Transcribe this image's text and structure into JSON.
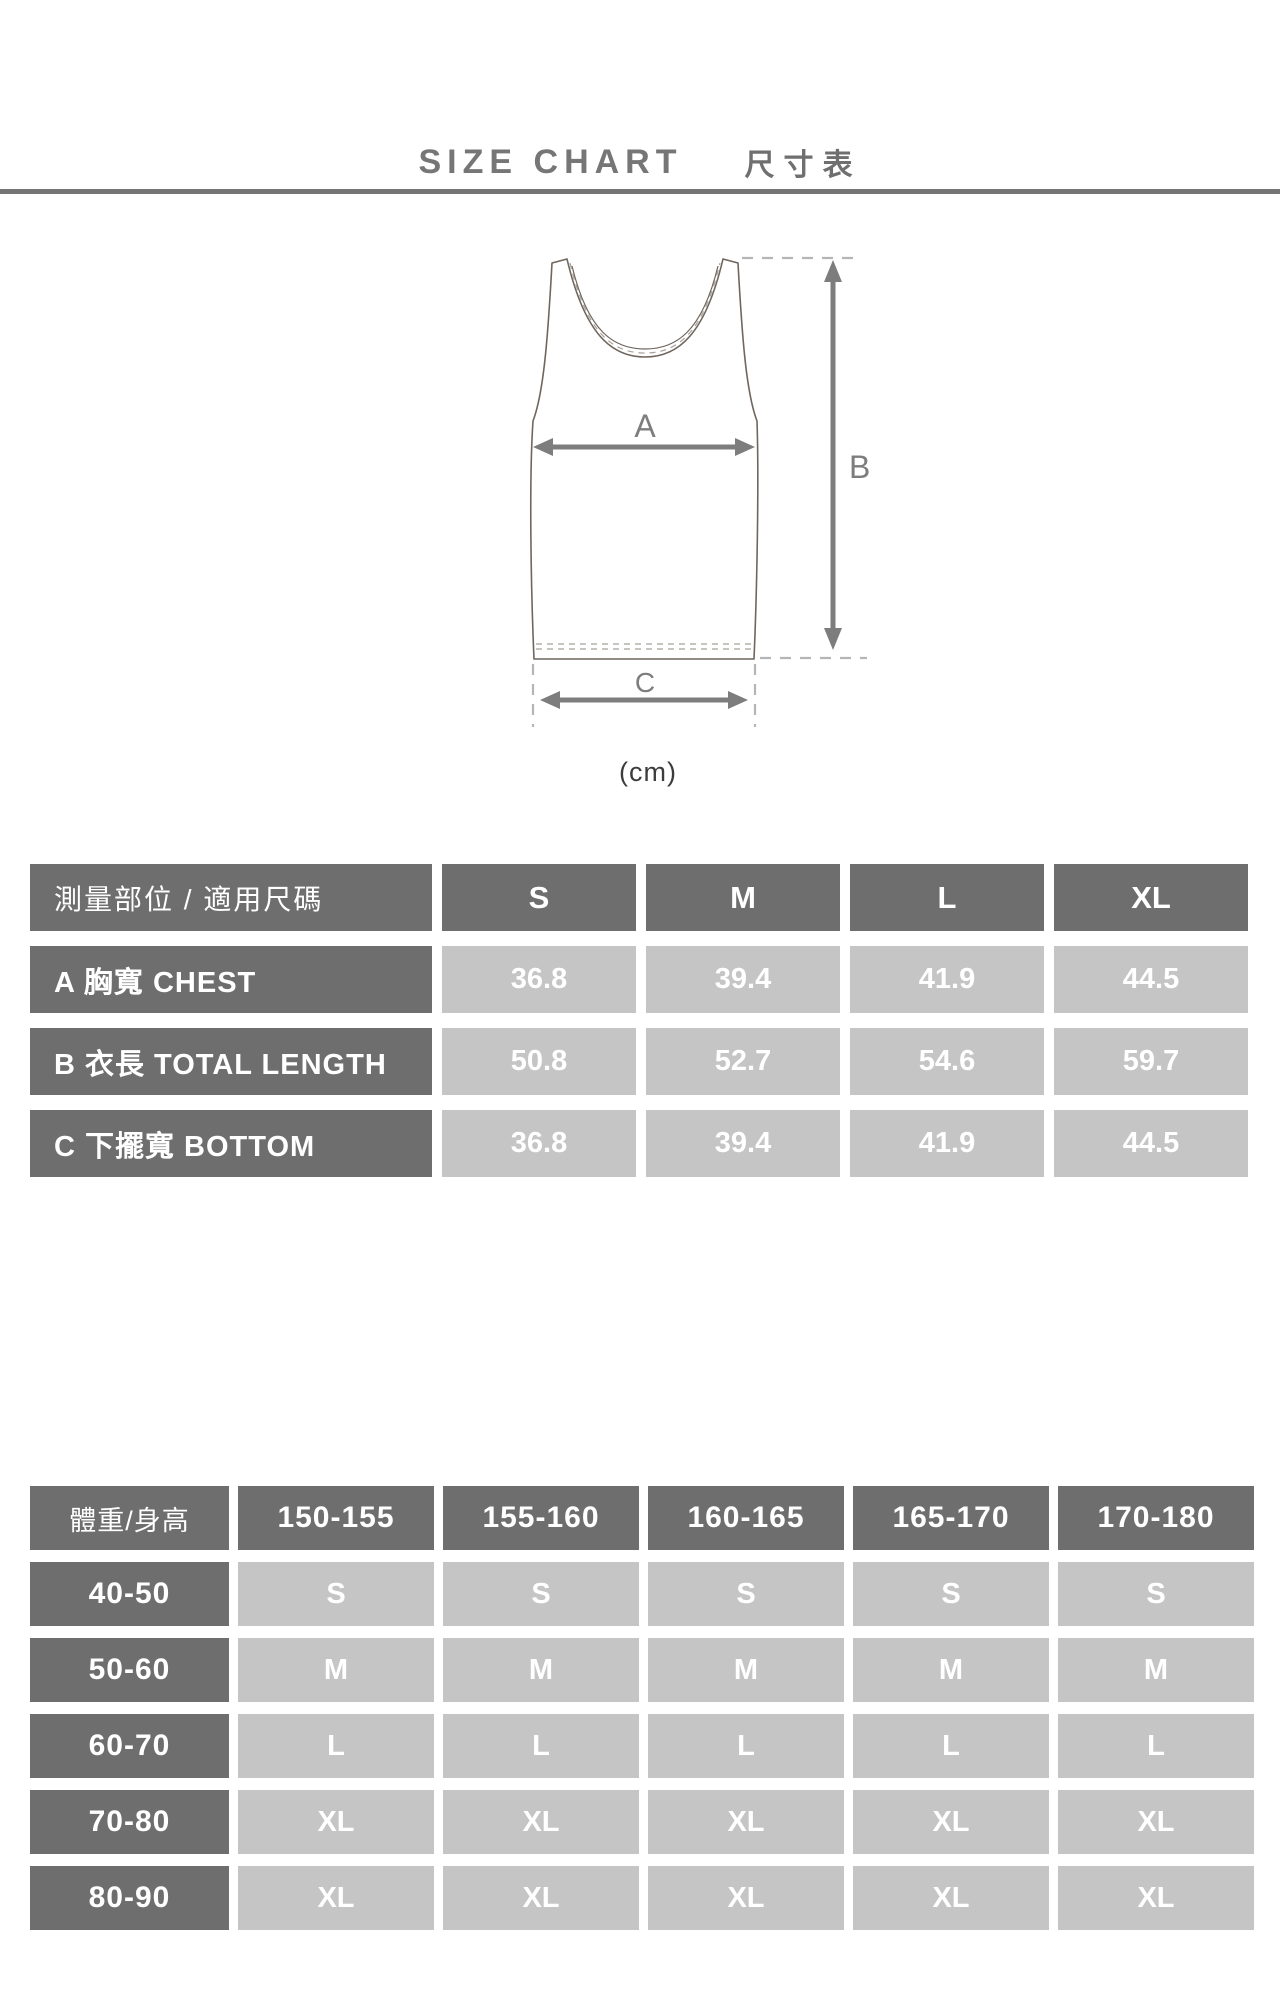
{
  "title": {
    "en": "SIZE CHART",
    "zh": "尺寸表"
  },
  "diagram": {
    "arrow_a_label": "A",
    "arrow_b_label": "B",
    "arrow_c_label": "C",
    "unit_label": "(cm)"
  },
  "measurement_table": {
    "header_label": "測量部位 / 適用尺碼",
    "size_headers": [
      "S",
      "M",
      "L",
      "XL"
    ],
    "rows": [
      {
        "label": "A 胸寬  CHEST",
        "values": [
          "36.8",
          "39.4",
          "41.9",
          "44.5"
        ]
      },
      {
        "label": "B 衣長  TOTAL LENGTH",
        "values": [
          "50.8",
          "52.7",
          "54.6",
          "59.7"
        ]
      },
      {
        "label": "C 下擺寬  BOTTOM",
        "values": [
          "36.8",
          "39.4",
          "41.9",
          "44.5"
        ]
      }
    ]
  },
  "fit_table": {
    "corner_label": "體重/身高",
    "height_headers": [
      "150-155",
      "155-160",
      "160-165",
      "165-170",
      "170-180"
    ],
    "rows": [
      {
        "label": "40-50",
        "values": [
          "S",
          "S",
          "S",
          "S",
          "S"
        ]
      },
      {
        "label": "50-60",
        "values": [
          "M",
          "M",
          "M",
          "M",
          "M"
        ]
      },
      {
        "label": "60-70",
        "values": [
          "L",
          "L",
          "L",
          "L",
          "L"
        ]
      },
      {
        "label": "70-80",
        "values": [
          "XL",
          "XL",
          "XL",
          "XL",
          "XL"
        ]
      },
      {
        "label": "80-90",
        "values": [
          "XL",
          "XL",
          "XL",
          "XL",
          "XL"
        ]
      }
    ]
  },
  "colors": {
    "dark_cell": "#6e6e6e",
    "light_cell": "#c5c5c5",
    "accent_gray": "#7d7d7d",
    "divider": "#757575"
  }
}
